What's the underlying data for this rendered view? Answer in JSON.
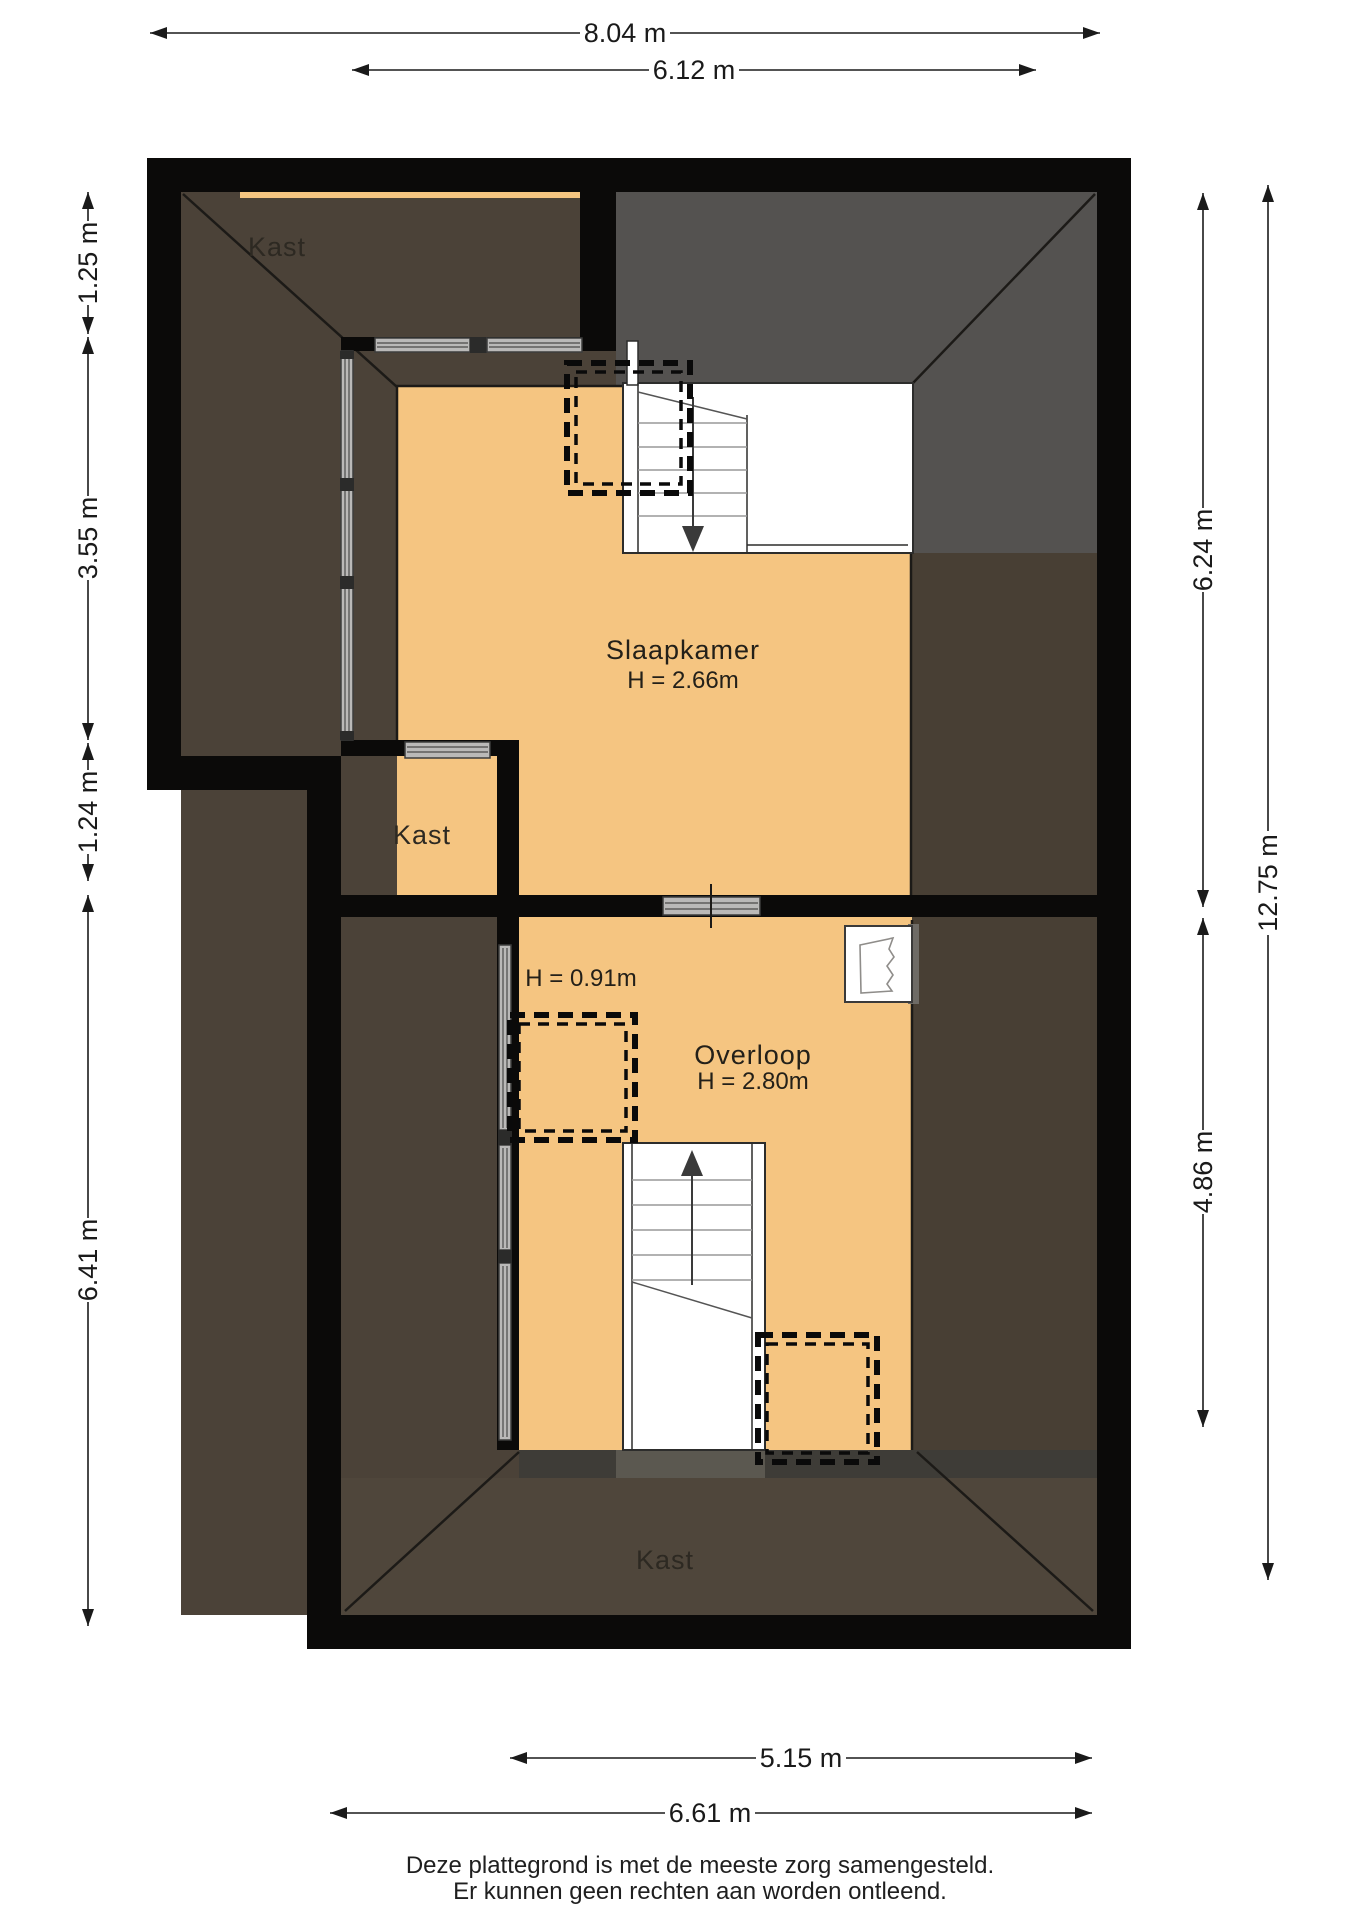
{
  "colors": {
    "wall": "#0b0a09",
    "orange": "#f5c581",
    "kast_brown": "#4b4238",
    "zone_brown": "#483f34",
    "kast_bottom_brown": "#4f463b",
    "roof_gray": "#545250",
    "band_dark": "#3e3c37",
    "band_light": "#5b5850",
    "white": "#ffffff",
    "dormer_edge": "#6e6b66"
  },
  "rooms": {
    "kast_top_left": {
      "label": "Kast"
    },
    "slaapkamer": {
      "label": "Slaapkamer",
      "height": "H = 2.66m"
    },
    "kast_middle": {
      "label": "Kast"
    },
    "overloop": {
      "label": "Overloop",
      "height": "H = 2.80m",
      "low_height_note": "H = 0.91m"
    },
    "kast_bottom": {
      "label": "Kast"
    }
  },
  "dimensions": {
    "top": [
      {
        "value": "8.04 m"
      },
      {
        "value": "6.12 m"
      }
    ],
    "left": [
      {
        "value": "1.25 m"
      },
      {
        "value": "3.55 m"
      },
      {
        "value": "1.24 m"
      },
      {
        "value": "6.41 m"
      }
    ],
    "right": [
      {
        "value": "6.24 m"
      },
      {
        "value": "4.86 m"
      },
      {
        "value": "12.75 m"
      }
    ],
    "bottom": [
      {
        "value": "5.15 m"
      },
      {
        "value": "6.61 m"
      }
    ]
  },
  "footer": {
    "line1": "Deze plattegrond is met de meeste zorg samengesteld.",
    "line2": "Er kunnen geen rechten aan worden ontleend."
  }
}
